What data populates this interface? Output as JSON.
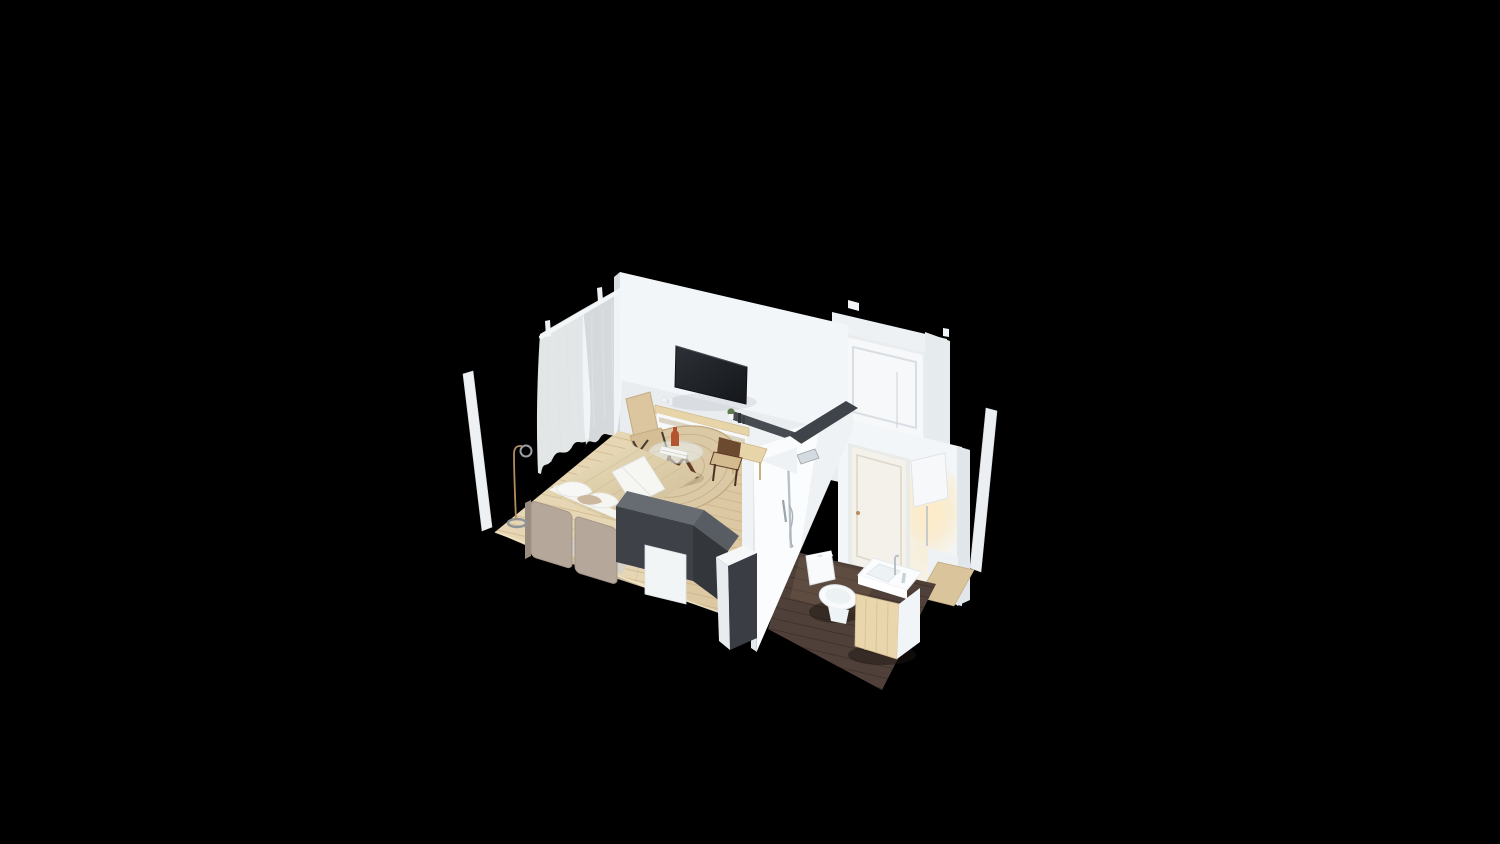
{
  "meta": {
    "kind": "3d-isometric-room-render",
    "style": "dollhouse cutaway on black background",
    "render_width": 1500,
    "render_height": 844
  },
  "colors": {
    "background": "#000000",
    "wall": "#f3f6f8",
    "wall_edge": "#d6dbdf",
    "entry_wall": "#eef1f4",
    "door_white": "#f6f8fa",
    "door_cream": "#f3f1ea",
    "cap_dark": "#3f434a",
    "floor_wood": "#e7d6b3",
    "bath_floor": "#50403a",
    "rug": "#dbc9a5",
    "rug_ring": "#c7b28a",
    "curtain": "#f4f7f9",
    "duvet": "#ddcfab",
    "sheet": "#f4f4f1",
    "headboard": "#b5a89a",
    "bench_dark": "#3e4147",
    "bench_top": "#676b72",
    "tv_screen": "#1f2227",
    "wood_light": "#e8d4a9",
    "walnut": "#5e3a26",
    "terracotta": "#b4532f",
    "chrome": "#b9c1c8",
    "brass": "#b28e5d",
    "glow": "#ffe9c2",
    "porcelain": "#f8fafb",
    "shower_wall": "#fafcfd",
    "vanity_wood": "#e9d6ad"
  },
  "scene": {
    "areas": [
      {
        "name": "bedroom",
        "floor": "light oak planks",
        "objects": [
          "double bed",
          "upholstered headboard cushions",
          "white pillows",
          "tan bolster pillow",
          "beige duvet",
          "white folded runner",
          "sheer white canopy curtains",
          "curtain rail",
          "round braided jute rug",
          "round glass coffee table with walnut cross legs",
          "terracotta vase",
          "stack of books",
          "woven folding lounge chair",
          "wood media console with decor",
          "wall mounted tv",
          "small wood desk",
          "woven desk chair",
          "dark charcoal foot bench",
          "white bedside cabinet",
          "brass arc floor lamp"
        ]
      },
      {
        "name": "bathroom",
        "floor": "dark walnut",
        "objects": [
          "walk-in shower chrome column",
          "chrome shower shelf",
          "one-piece toilet",
          "wood vanity cabinet",
          "white counter basin",
          "tall chrome faucet",
          "interior door with brass knob",
          "glowing wall sconce",
          "half walls with dark caps"
        ]
      },
      {
        "name": "entry",
        "objects": [
          "white paneled entry door",
          "door frame tabs",
          "hallway wood floor strip"
        ]
      },
      {
        "name": "exterior",
        "objects": [
          "freestanding white panel left",
          "freestanding white panel right"
        ]
      }
    ]
  }
}
